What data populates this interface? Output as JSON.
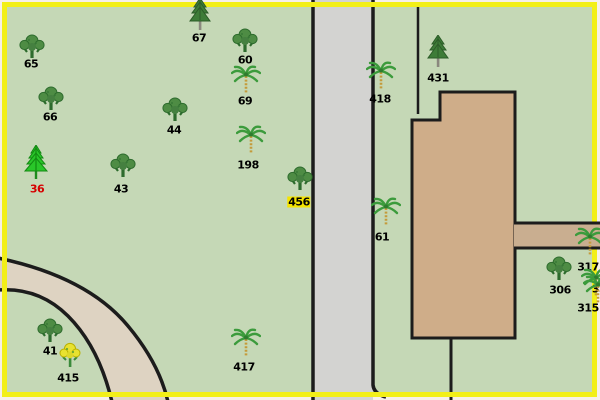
{
  "map": {
    "colors": {
      "rim": "#f6efe9",
      "frame": "#f2ef18",
      "field": "#c5d8b6",
      "road": "#d3d3d1",
      "path": "#ded3c2",
      "building": "#cfad89",
      "band": "#c9ae90",
      "outline": "#1c1c1c",
      "label_default": "#000000",
      "label_alert": "#d60000",
      "label_highlight": "#f5e400"
    },
    "features": {
      "vertical_road": "paved road running top to bottom",
      "curved_road": "curved drive lower left",
      "building": "building footprint upper right",
      "side_path": "path from building to right edge"
    },
    "trees": [
      {
        "label": "65",
        "type": "deciduous",
        "icon": "deciduous-tree-icon",
        "tx": 32,
        "ty": 49,
        "lx": 31,
        "ly": 64
      },
      {
        "label": "66",
        "type": "deciduous",
        "icon": "deciduous-tree-icon",
        "tx": 51,
        "ty": 101,
        "lx": 50,
        "ly": 117
      },
      {
        "label": "67",
        "type": "conifer",
        "icon": "conifer-tree-icon",
        "tx": 200,
        "ty": 15,
        "lx": 199,
        "ly": 38
      },
      {
        "label": "60",
        "type": "deciduous",
        "icon": "deciduous-tree-icon",
        "tx": 245,
        "ty": 43,
        "lx": 245,
        "ly": 60
      },
      {
        "label": "69",
        "type": "palm",
        "icon": "palm-tree-icon",
        "tx": 246,
        "ty": 82,
        "lx": 245,
        "ly": 101
      },
      {
        "label": "44",
        "type": "deciduous",
        "icon": "deciduous-tree-icon",
        "tx": 175,
        "ty": 112,
        "lx": 174,
        "ly": 130
      },
      {
        "label": "198",
        "type": "palm",
        "icon": "palm-tree-icon",
        "tx": 251,
        "ty": 142,
        "lx": 248,
        "ly": 165
      },
      {
        "label": "43",
        "type": "deciduous",
        "icon": "deciduous-tree-icon",
        "tx": 123,
        "ty": 168,
        "lx": 121,
        "ly": 189
      },
      {
        "label": "36",
        "type": "spruce",
        "icon": "spruce-tree-icon",
        "tx": 36,
        "ty": 162,
        "lx": 37,
        "ly": 189,
        "color": "#d60000"
      },
      {
        "label": "456",
        "type": "deciduous",
        "icon": "deciduous-tree-icon",
        "tx": 300,
        "ty": 181,
        "lx": 299,
        "ly": 202,
        "highlight": "#f5e400"
      },
      {
        "label": "418",
        "type": "palm",
        "icon": "palm-tree-icon",
        "tx": 381,
        "ty": 78,
        "lx": 380,
        "ly": 99
      },
      {
        "label": "431",
        "type": "conifer",
        "icon": "conifer-tree-icon",
        "tx": 438,
        "ty": 52,
        "lx": 438,
        "ly": 78
      },
      {
        "label": "61",
        "type": "palm",
        "icon": "palm-tree-icon",
        "tx": 386,
        "ty": 214,
        "lx": 382,
        "ly": 237
      },
      {
        "label": "41",
        "type": "deciduous",
        "icon": "deciduous-tree-icon",
        "tx": 50,
        "ty": 333,
        "lx": 50,
        "ly": 351
      },
      {
        "label": "415",
        "type": "flower",
        "icon": "flowering-tree-icon",
        "tx": 70,
        "ty": 356,
        "lx": 68,
        "ly": 378
      },
      {
        "label": "417",
        "type": "palm",
        "icon": "palm-tree-icon",
        "tx": 246,
        "ty": 345,
        "lx": 244,
        "ly": 367
      },
      {
        "label": "306",
        "type": "deciduous",
        "icon": "deciduous-tree-icon",
        "tx": 559,
        "ty": 271,
        "lx": 560,
        "ly": 290
      },
      {
        "label": "317",
        "type": "palm",
        "icon": "palm-tree-icon",
        "tx": 590,
        "ty": 244,
        "lx": 588,
        "ly": 267
      },
      {
        "label": "33",
        "type": "palm",
        "icon": "palm-tree-icon",
        "tx": 596,
        "ty": 285,
        "lx": 591,
        "ly": 289,
        "align": "left"
      },
      {
        "label": "315",
        "type": "palm",
        "icon": "palm-tree-icon",
        "tx": 598,
        "ty": 292,
        "lx": 588,
        "ly": 308
      }
    ]
  }
}
